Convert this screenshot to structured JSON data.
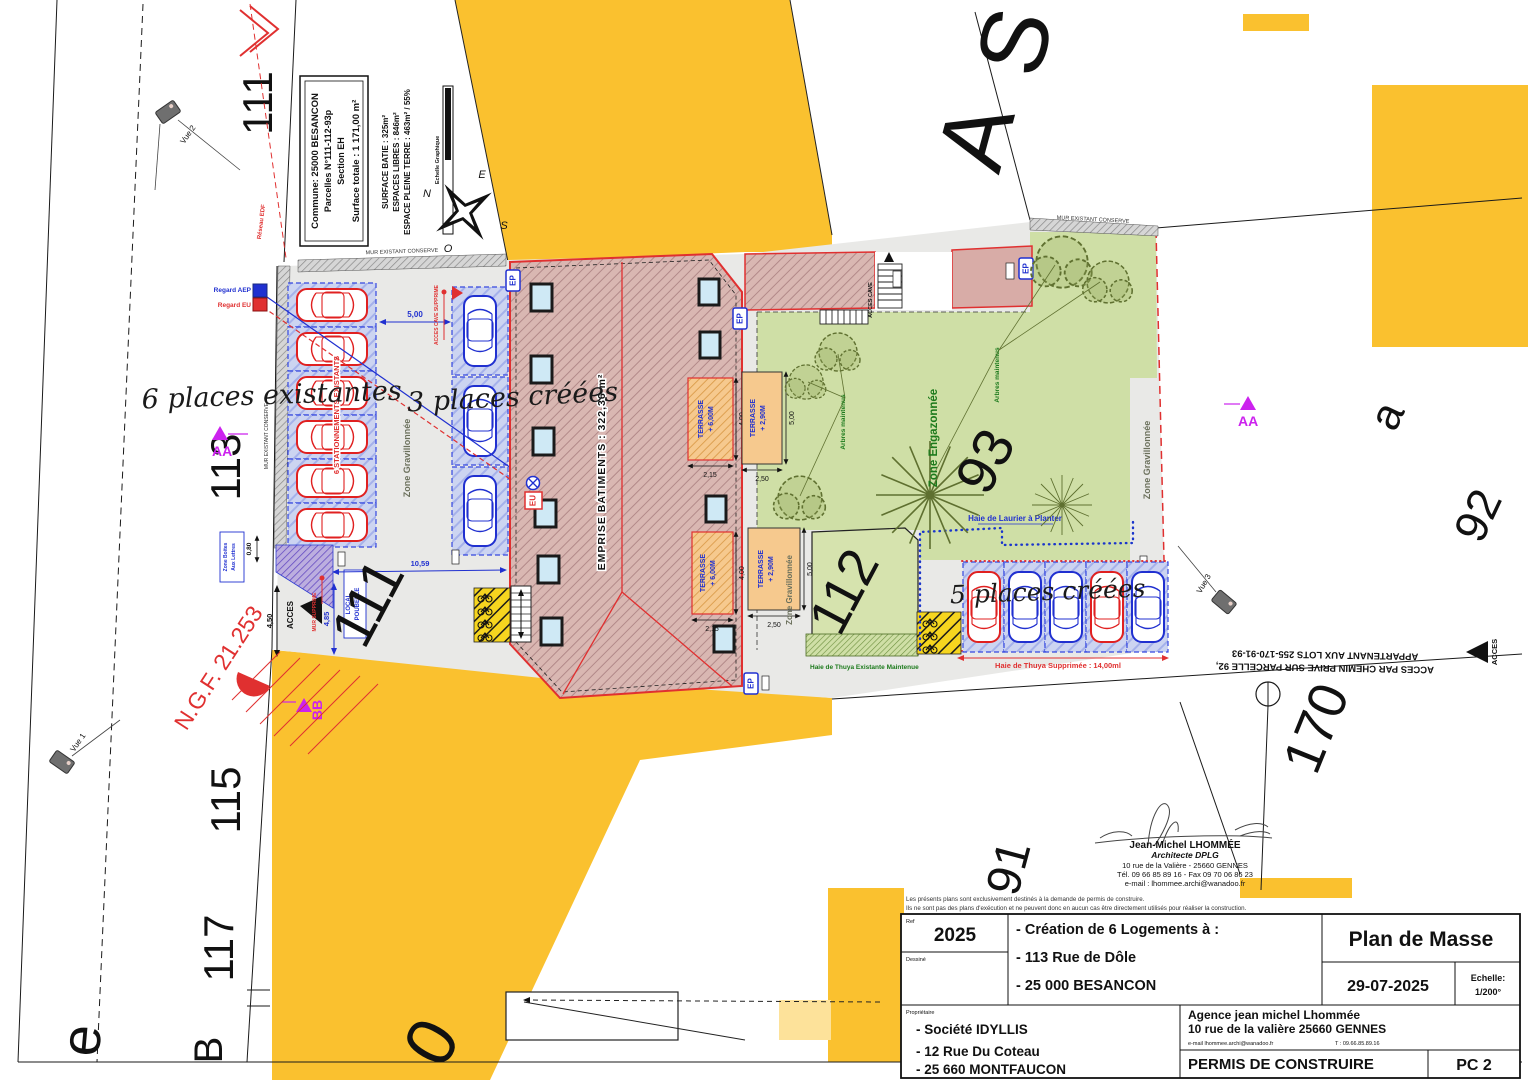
{
  "info_box": {
    "commune": "Commune: 25000 BESANCON",
    "parcelles": "Parcelles  N°111-112-93p",
    "section": "Section EH",
    "surface_totale": "Surface totale : 1 171,00 m²"
  },
  "surfaces": {
    "batie": "SURFACE BATIE : 325m²",
    "libres": "ESPACES LIBRES : 846m²",
    "pleine_terre": "ESPACE PLEINE TERRE : 463m² / 55%"
  },
  "scale_bar": {
    "label": "Echelle Graphique"
  },
  "compass": {
    "n": "N",
    "e": "E",
    "s": "S",
    "o": "O"
  },
  "networks": {
    "reseau_edf": "Réseau EDF"
  },
  "regards": {
    "aep": "Regard AEP",
    "eu": "Regard EU"
  },
  "markers": {
    "ep": "EP",
    "eu": "EU",
    "acces": "ACCES",
    "acces_cave": "ACCES CAVE",
    "acces_cave_supprime": "ACCES CAVE SUPPRIME",
    "mur_supprime": "MUR SUPPRIME",
    "mur_existant": "MUR EXISTANT CONSERVE",
    "ngf": "N.G.F. 21.253"
  },
  "sections": {
    "aa": "AA",
    "bb": "BB"
  },
  "views": {
    "v1": "Vue 1",
    "v2": "Vue 2",
    "v3": "Vue 3"
  },
  "zones": {
    "gravillonnee": "Zone Gravillonnée",
    "engazonnee": "Zone Engazonnée",
    "boites1": "Zone Boites",
    "boites2": "Aux Lettres",
    "local1": "LOCAL",
    "local2": "POUBELLE"
  },
  "parking": {
    "p6": "6 places existantes",
    "p3": "3 places créées",
    "p5": "5 places créées",
    "stationnements": "6 STATIONNEMENTS EXISTANTS"
  },
  "building": {
    "emprise": "EMPRISE BATIMENTS : 322,36 m²",
    "terrasse": "TERRASSE",
    "t600": "+ 6,00M",
    "t290": "+ 2,90M"
  },
  "dims": {
    "d500": "5,00",
    "d1059": "10,59",
    "d450": "4,50",
    "d485": "4,85",
    "d080": "0,80",
    "d215": "2,15",
    "d400": "4,00",
    "d250": "2,50"
  },
  "hedges": {
    "laurier": "Haie de Laurier à Planter",
    "thuya_maintenue": "Haie de Thuya Existante Maintenue",
    "thuya_supprimee": "Haie de Thuya Supprimée : 14,00ml",
    "arbres": "Arbres maintenus"
  },
  "chemin": {
    "l1": "ACCES PAR CHEMIN PRIVE SUR PARCELLE 92,",
    "l2": "APPARTENANT AUX LOTS 255-170-91-93"
  },
  "parcels": {
    "p111": "111",
    "p112": "112",
    "p113": "113",
    "p115": "115",
    "p117": "117",
    "p93": "93",
    "p91": "91",
    "p92": "92",
    "p170": "170",
    "pa": "a",
    "pA": "A",
    "pS": "S",
    "pe": "e",
    "pB": "B",
    "p0": "0"
  },
  "stamp": {
    "name": "Jean-Michel LHOMMÉE",
    "title": "Architecte DPLG",
    "addr": "10 rue de la Valière - 25660 GENNES",
    "telfax": "Tél. 09 66 85 89 16 - Fax 09 70 06 86 23",
    "email": "e-mail : lhommee.archi@wanadoo.fr"
  },
  "title_block": {
    "disc1": "Les présents plans sont exclusivement destinés à la demande de permis de construire.",
    "disc2": "Ils ne sont pas des plans d'exécution et ne peuvent donc en aucun cas être directement utilisés pour réaliser la construction.",
    "ref_label": "Ref",
    "ref": "2025",
    "dessine": "Dessiné",
    "proj1": "- Création de 6 Logements à :",
    "proj2": "- 113 Rue de Dôle",
    "proj3": "- 25 000 BESANCON",
    "plan": "Plan de Masse",
    "date": "29-07-2025",
    "ech_label": "Echelle:",
    "ech": "1/200°",
    "prop_label": "Propriétaire",
    "own1": "- Société IDYLLIS",
    "own2": "- 12 Rue Du Coteau",
    "own3": "- 25 660 MONTFAUCON",
    "ag1": "Agence jean michel Lhommée",
    "ag2": "10 rue de la valière 25660 GENNES",
    "ag_email": "e-mail lhommee.archi@wanadoo.fr",
    "ag_tel": "T : 09.66.85.89.16",
    "permit": "PERMIS DE CONSTRUIRE",
    "sheet": "PC 2"
  },
  "colors": {
    "road": "#FAC12F",
    "lawn": "#CFDFA6",
    "building": "#D8B6B1",
    "accent_red": "#E03030",
    "accent_blue": "#2030D0",
    "magenta": "#CC22EE"
  }
}
